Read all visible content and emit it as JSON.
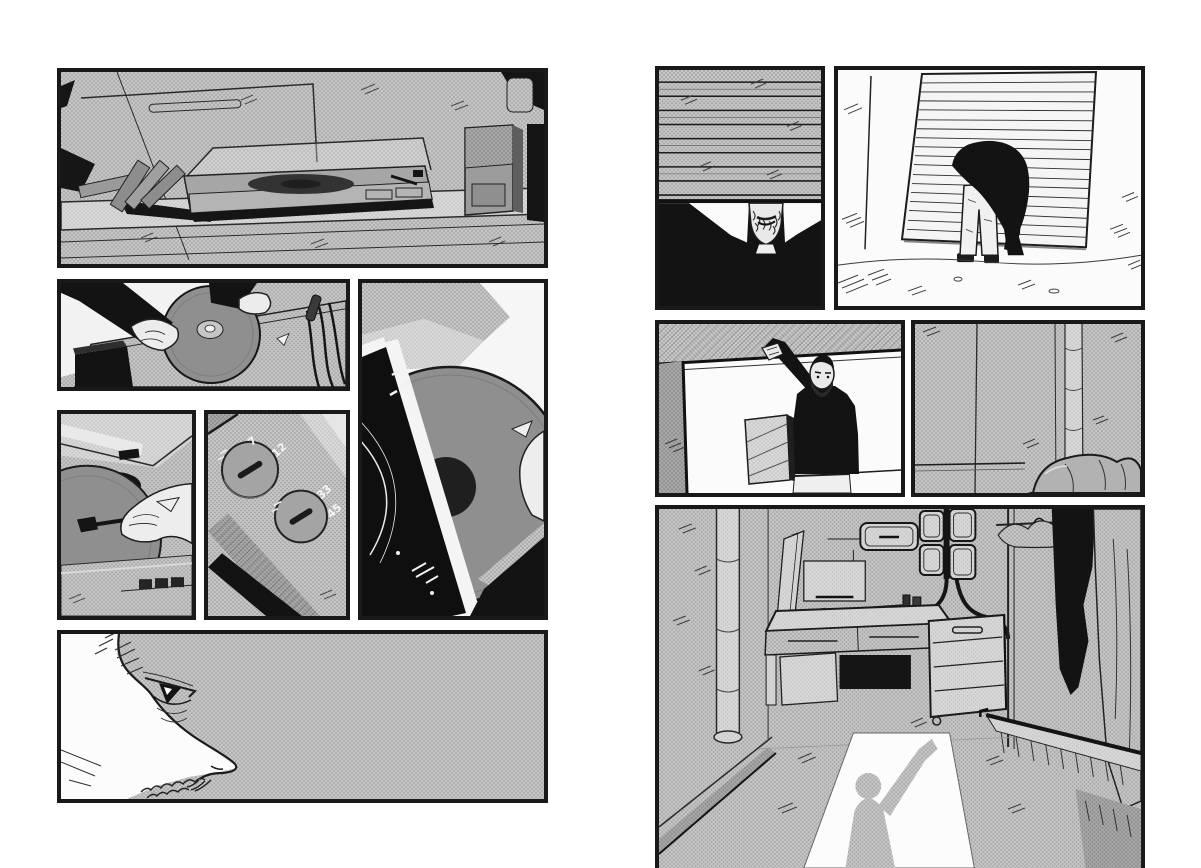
{
  "document": {
    "title": "Black-and-white manga two-page spread",
    "media": "comic page spread, halftone screentone artwork, no dialogue"
  },
  "colors": {
    "paper": "#ffffff",
    "ink": "#1a1a1a",
    "halftone": "#c7c7c7",
    "halftone_dot": "#9d9d9d",
    "solid_black": "#131313"
  },
  "spread": {
    "left_page": {
      "panels": [
        {
          "id": "turntable-shelf",
          "alt": "Wide establishing panel: a turntable with its dust cover open sits on a wooden shelf; records lean against the wall at left and a tall speaker stands at the right."
        },
        {
          "id": "placing-record",
          "alt": "Hands in dark sleeves lower a vinyl record onto the turntable platter; audio cables hang at the right."
        },
        {
          "id": "record-and-sleeve",
          "alt": "Tall close-up: the vinyl record is slid out of a black sleeve with a white border while a hand steadies it from the right."
        },
        {
          "id": "setting-tonearm",
          "alt": "Close-up: a hand guides the tonearm onto the edge of the record beneath the open dust cover."
        },
        {
          "id": "speed-selector",
          "alt": "Extreme close-up of the turntable's two selector knobs, labelled 7 / 12 for record size and 33 / 45 for speed."
        },
        {
          "id": "listening-profile",
          "alt": "Profile close-up of a bearded man facing right against grey halftone."
        }
      ]
    },
    "right_page": {
      "panels": [
        {
          "id": "behind-the-shutter",
          "alt": "A man in black stands behind a half-lowered roller shutter; the slats hide his eyes and only his bearded mouth shows."
        },
        {
          "id": "ducking-under-shutter",
          "alt": "Seen from behind, a figure in a dark jacket and light trousers stoops to pass beneath the partly raised shutter."
        },
        {
          "id": "pulling-the-shutter",
          "alt": "Inside, the bearded man reaches up to pull the shutter closed; a slatted crate sits in front of him beneath the grey beam."
        },
        {
          "id": "room-wall",
          "alt": "Grey panelled wall of the small room with rolled bedding in the lower right corner."
        },
        {
          "id": "room-interior",
          "alt": "The room: a desk with a turntable, wall cabinets, a drawer unit and hanging clothes; doorway light throws the man's long shadow across the floor."
        }
      ]
    }
  },
  "speed_selector": {
    "size_labels": [
      "7",
      "12"
    ],
    "speed_labels": [
      "33",
      "45"
    ]
  }
}
